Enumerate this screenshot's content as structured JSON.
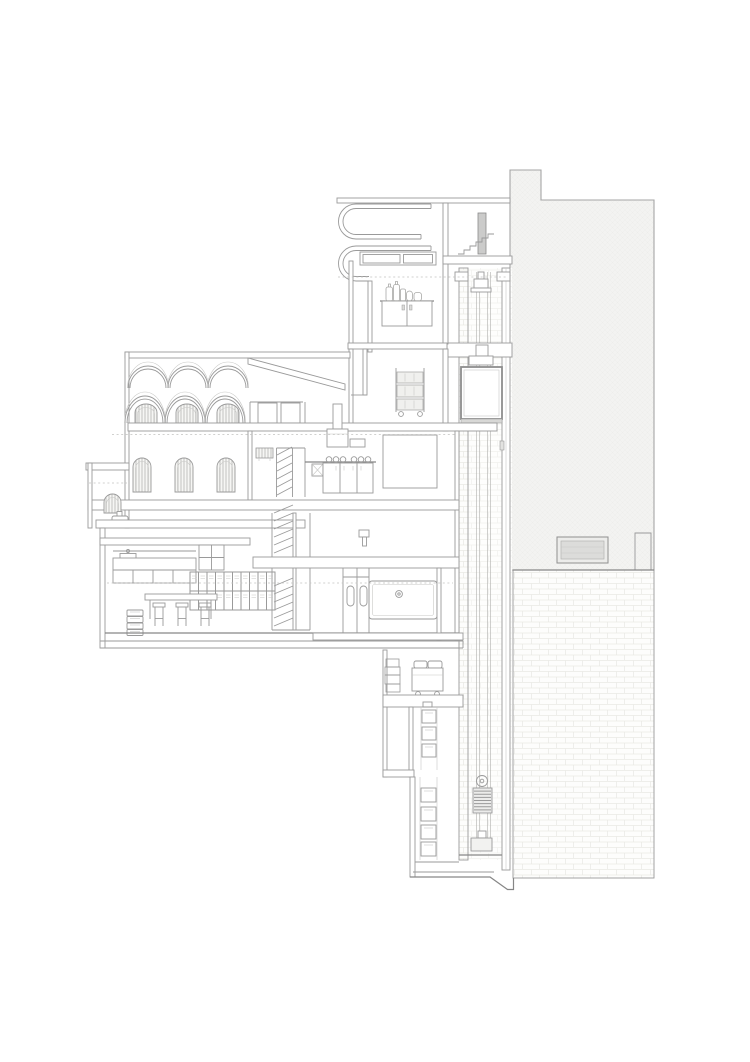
{
  "canvas": {
    "width": 750,
    "height": 1062,
    "background": "#ffffff"
  },
  "palette": {
    "line": "#9a9a9a",
    "line_dark": "#868686",
    "line_light": "#c8c8c6",
    "dashed_line": "#c2c2c0",
    "block_fill": "#f3f3f1",
    "block_texture": "#ebebe8",
    "brick_line": "#e9e9e5",
    "brick_faint": "#f1f1ee",
    "door_fill": "#cbcbca",
    "recess_fill": "#ececea",
    "recess_inner": "#dcdcda",
    "sill_fill": "#d8d8d6",
    "car_stroke": "#8d8d8d",
    "hatch_fill": "#f6f6f4",
    "hatch_line": "#adadab"
  },
  "components": {
    "vault_arches": {
      "count": 3,
      "x0": 128,
      "span": 40,
      "base_y": 388,
      "rise": 22
    },
    "dome_arches": {
      "count": 3,
      "x0": 125,
      "span": 40,
      "base_y": 423,
      "rise": 27
    },
    "dome_vents": {
      "xs": [
        135,
        176,
        217
      ],
      "y": 404,
      "width": 22,
      "height": 19
    },
    "arched_windows": {
      "xs": [
        133,
        175,
        217
      ],
      "y": 458,
      "width": 18,
      "height": 34
    },
    "annex_window": {
      "x": 104,
      "y": 494,
      "width": 17,
      "height": 19
    },
    "lockers": {
      "x": 190,
      "y": 572,
      "cols": 10,
      "rows": 2,
      "cell_w": 8.5,
      "cell_h": 19
    },
    "burners": {
      "cxs": [
        329,
        336,
        343,
        354,
        361,
        368
      ],
      "cy": 459.5,
      "r": 2.8
    },
    "stools": {
      "xs": [
        153,
        176,
        199
      ],
      "y": 603,
      "seat_w": 12,
      "seat_h": 4,
      "leg_h": 19
    },
    "stacked_stools": {
      "x": 127,
      "y": 610,
      "count": 4,
      "w": 16,
      "h": 6
    },
    "counterweight": {
      "x": 473,
      "y": 788,
      "w": 19,
      "h": 25,
      "stripes": 7
    },
    "shelf_boxes_upper": {
      "x": 422,
      "w": 14,
      "h": 13,
      "ys": [
        710,
        727,
        744
      ]
    },
    "shelf_boxes_lower": {
      "x": 421,
      "w": 15,
      "h": 14,
      "ys": [
        788,
        807,
        825,
        842
      ]
    },
    "trolley_shelves": {
      "x": 397,
      "w": 26,
      "ys": [
        372,
        385,
        399
      ],
      "hs": [
        11,
        12,
        11
      ]
    },
    "stair_flights": [
      {
        "x1": 277,
        "x2": 292,
        "y_start": 495,
        "step": 8,
        "count": 6
      },
      {
        "x1": 274,
        "x2": 293,
        "y_start": 553,
        "step": 8,
        "count": 6
      },
      {
        "x1": 274,
        "x2": 293,
        "y_start": 626,
        "step": 8,
        "count": 6
      }
    ],
    "reference_dashes": [
      {
        "y": 277,
        "x1": 338,
        "x2": 507
      },
      {
        "y": 434.5,
        "x1": 112,
        "x2": 455
      },
      {
        "y": 483,
        "x1": 89,
        "x2": 127
      },
      {
        "y": 583,
        "x1": 107,
        "x2": 453
      }
    ]
  }
}
